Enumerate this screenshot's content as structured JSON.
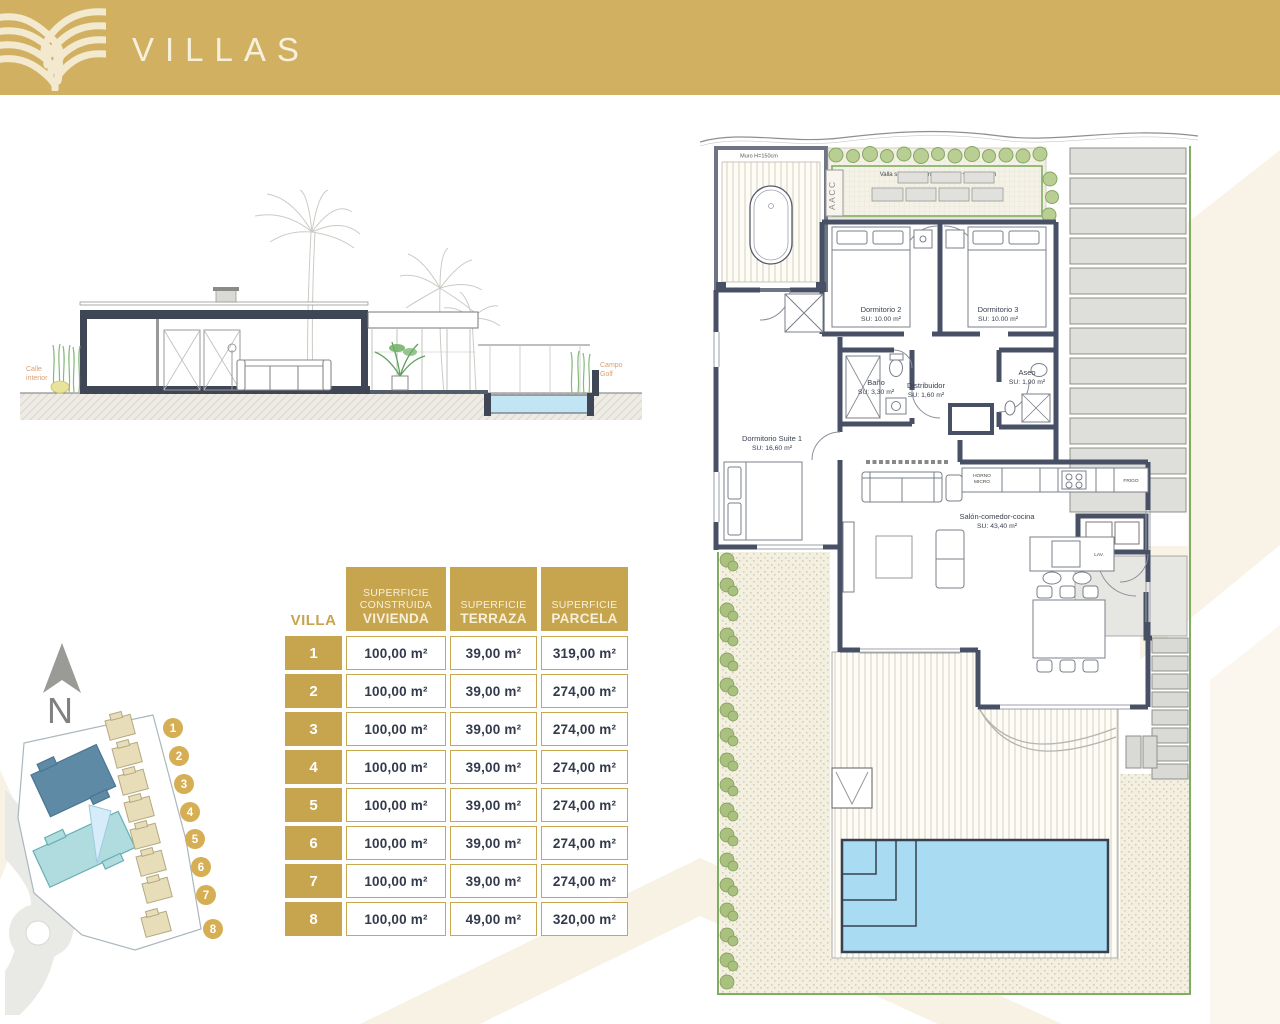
{
  "header": {
    "title": "VILLAS"
  },
  "section": {
    "label_left_line1": "Calle",
    "label_left_line2": "interior",
    "label_right_line1": "Campo",
    "label_right_line2": "Golf"
  },
  "floor_plan": {
    "wall_note": "Muro H=150cm",
    "fence_note": "Valla simple torsión H= 160cm + vegetación",
    "ac_label": "AACC",
    "rooms": [
      {
        "name": "Dormitorio 2",
        "area": "SU: 10.00 m²"
      },
      {
        "name": "Dormitorio 3",
        "area": "SU: 10.00 m²"
      },
      {
        "name": "Baño",
        "area": "SU: 3,30 m²"
      },
      {
        "name": "Distribuidor",
        "area": "SU: 1,60 m²"
      },
      {
        "name": "Aseo",
        "area": "SU: 1,90 m²"
      },
      {
        "name": "Dormitorio Suite 1",
        "area": "SU: 16,60 m²"
      },
      {
        "name": "Salón-comedor-cocina",
        "area": "SU: 43,40 m²"
      }
    ],
    "kitchen": {
      "oven_line1": "HORNO",
      "oven_line2": "MICRO",
      "fridge": "FRIGO",
      "sink": "LAV."
    }
  },
  "table": {
    "row_header": "VILLA",
    "columns": [
      {
        "line1": "SUPERFICIE",
        "line2": "CONSTRUIDA",
        "emphasis": "VIVIENDA"
      },
      {
        "line1": "SUPERFICIE",
        "emphasis": "TERRAZA"
      },
      {
        "line1": "SUPERFICIE",
        "emphasis": "PARCELA"
      }
    ],
    "rows": [
      {
        "villa": "1",
        "vivienda": "100,00 m²",
        "terraza": "39,00 m²",
        "parcela": "319,00 m²"
      },
      {
        "villa": "2",
        "vivienda": "100,00 m²",
        "terraza": "39,00 m²",
        "parcela": "274,00 m²"
      },
      {
        "villa": "3",
        "vivienda": "100,00 m²",
        "terraza": "39,00 m²",
        "parcela": "274,00 m²"
      },
      {
        "villa": "4",
        "vivienda": "100,00 m²",
        "terraza": "39,00 m²",
        "parcela": "274,00 m²"
      },
      {
        "villa": "5",
        "vivienda": "100,00 m²",
        "terraza": "39,00 m²",
        "parcela": "274,00 m²"
      },
      {
        "villa": "6",
        "vivienda": "100,00 m²",
        "terraza": "39,00 m²",
        "parcela": "274,00 m²"
      },
      {
        "villa": "7",
        "vivienda": "100,00 m²",
        "terraza": "39,00 m²",
        "parcela": "274,00 m²"
      },
      {
        "villa": "8",
        "vivienda": "100,00 m²",
        "terraza": "49,00 m²",
        "parcela": "320,00 m²"
      }
    ]
  },
  "site_plan": {
    "north_label": "N",
    "markers": [
      "1",
      "2",
      "3",
      "4",
      "5",
      "6",
      "7",
      "8"
    ]
  },
  "colors": {
    "brand_gold": "#d2b061",
    "table_gold": "#c7a44e",
    "wall_navy": "#475064",
    "pool_blue": "#a9dcf2",
    "fence_green": "#7fae63"
  }
}
